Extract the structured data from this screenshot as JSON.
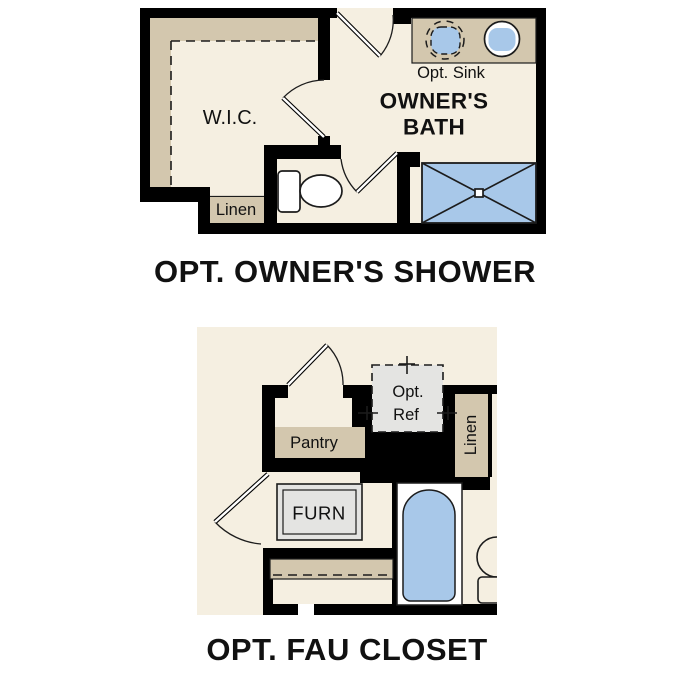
{
  "colors": {
    "paper_white": "#ffffff",
    "floor_cream": "#f5efe1",
    "shelf_tan": "#d3c7ae",
    "fixture_blue": "#a8c8e9",
    "appliance_gray": "#e4e4e2",
    "wall_black": "#000000",
    "outline_dark": "#1c1c1c",
    "text_black": "#111111"
  },
  "owners_shower_plan": {
    "title": "OPT. OWNER'S SHOWER",
    "labels": {
      "wic": "W.I.C.",
      "linen": "Linen",
      "opt_sink": "Opt. Sink",
      "bath_line1": "OWNER'S",
      "bath_line2": "BATH"
    }
  },
  "fau_closet_plan": {
    "title": "OPT. FAU CLOSET",
    "labels": {
      "pantry": "Pantry",
      "ref_line1": "Opt.",
      "ref_line2": "Ref",
      "linen": "Linen",
      "furnace": "FURN"
    }
  }
}
